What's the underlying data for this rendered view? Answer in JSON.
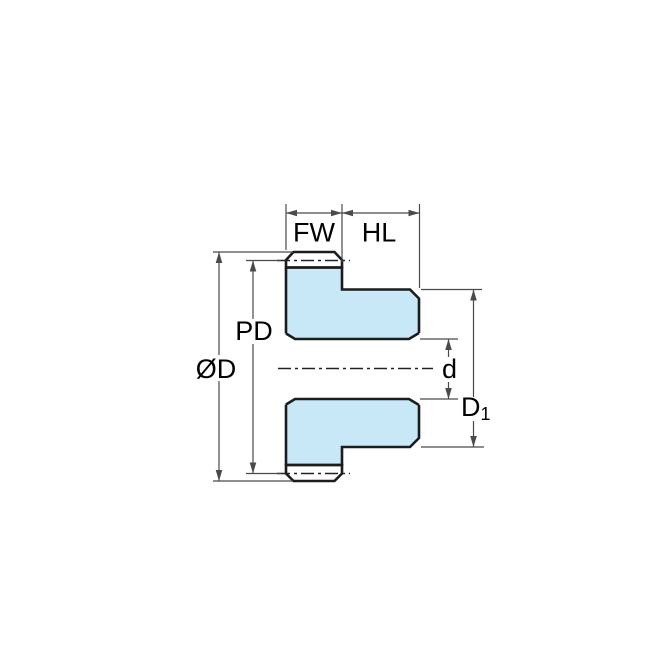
{
  "diagram": {
    "kind": "spur-gear-with-hub-cross-section-dimension-drawing",
    "labels": {
      "fw": "FW",
      "hl": "HL",
      "pd": "PD",
      "od": "ØD",
      "d": "d",
      "d1_base": "D",
      "d1_sub": "1"
    },
    "colors": {
      "part_fill": "#C8E7F7",
      "outline": "#1C1C1C",
      "dimension_lines": "#4A4A4A",
      "label_text": "#000000",
      "background": "#FFFFFF"
    }
  }
}
